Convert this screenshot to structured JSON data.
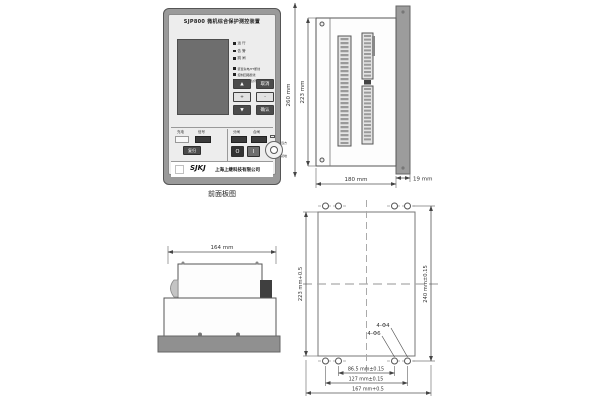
{
  "front_panel": {
    "caption": "前面板图",
    "title": "SJP800 微机综合保护测控装置",
    "leds": [
      {
        "label": "运 行"
      },
      {
        "label": "告 警"
      },
      {
        "label": "跳 闸"
      }
    ],
    "status_leds": [
      {
        "label": "装置失电/PT断线"
      },
      {
        "label": "控制回路断线"
      },
      {
        "label": "弹簧未储能/闭锁"
      }
    ],
    "keys": {
      "up": "▲",
      "cancel": "取消",
      "plus": "+",
      "minus": "-",
      "down": "▼",
      "confirm": "确认"
    },
    "signal_group": {
      "label_left": "充电",
      "label_right": "信号",
      "reset": "复归"
    },
    "control_group": {
      "label_open": "分闸",
      "label_close": "合闸",
      "off": "O",
      "on": "I",
      "knob_top": "远方",
      "knob_bottom": "就地"
    },
    "brand": {
      "logo": "SJKJ",
      "company": "上海上继科技有限公司"
    }
  },
  "side_view": {
    "dim_total_height": "260 mm",
    "dim_case_height": "223 mm",
    "dim_depth": "180 mm",
    "dim_panel": "19 mm"
  },
  "top_view": {
    "dim_width": "164 mm"
  },
  "cutout_view": {
    "dim_height": "223 mm+0.5",
    "dim_hole_height": "240 mm±0.15",
    "dim_hole_inner": "86.5 mm±0.15",
    "dim_hole_outer": "127 mm±0.15",
    "dim_width": "167 mm+0.5",
    "hole_label_a": "4-Φ4",
    "hole_label_b": "4-Φ6"
  }
}
